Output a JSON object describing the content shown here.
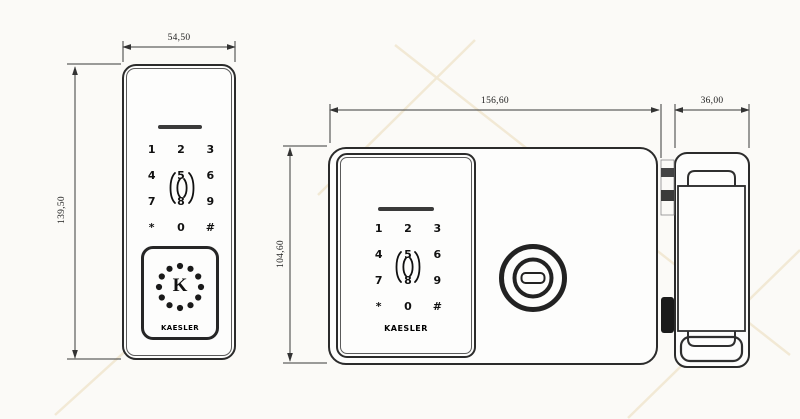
{
  "dimensions": {
    "front_width": "54,50",
    "front_height": "139,50",
    "body_width": "156,60",
    "body_height": "104,60",
    "side_width": "36,00"
  },
  "keypad": {
    "keys": [
      "1",
      "2",
      "3",
      "4",
      "5",
      "6",
      "7",
      "8",
      "9",
      "*",
      "0",
      "#"
    ]
  },
  "brand": {
    "name": "KAESLER",
    "logo_letter": "K"
  },
  "colors": {
    "outline": "#2b2b2b",
    "dimension_line": "#3a3a3a",
    "watermark": "#ead9b5"
  }
}
